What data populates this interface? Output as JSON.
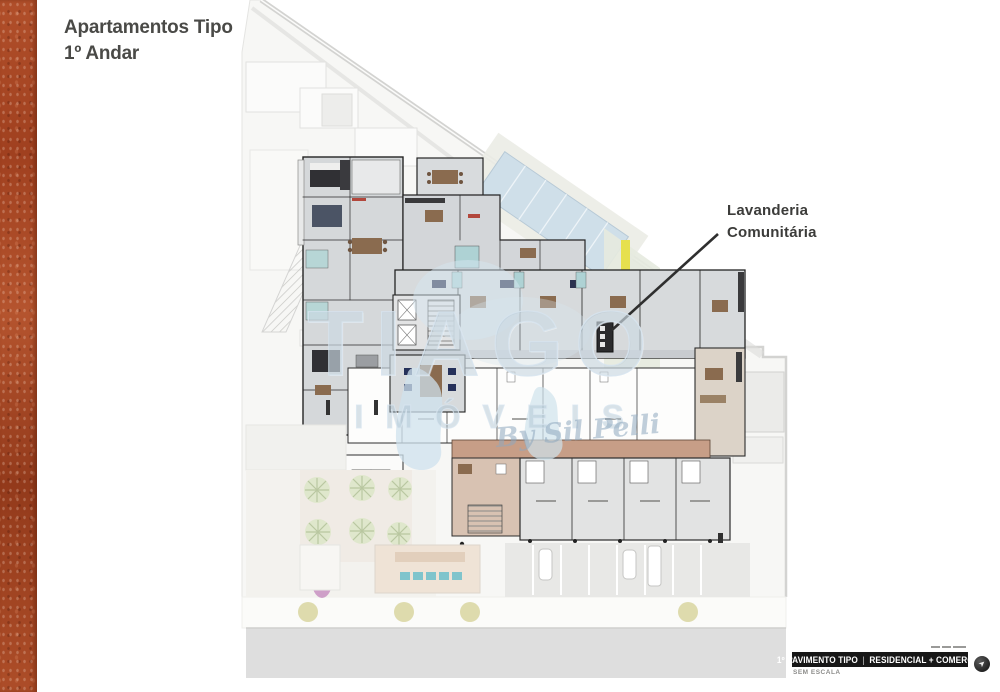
{
  "page": {
    "title": {
      "line1": "Apartamentos Tipo",
      "line2": "1º Andar"
    }
  },
  "plan": {
    "callout": {
      "line1": "Lavanderia",
      "line2": "Comunitária"
    }
  },
  "watermark": {
    "brand_top": "TIAGO",
    "brand_bottom": "IMÓVEIS",
    "tagline": "By Sil Pelli"
  },
  "footer": {
    "title_left": "1º PAVIMENTO TIPO",
    "divider": "|",
    "title_right": "RESIDENCIAL + COMERCIO",
    "scale_note": "SEM ESCALA",
    "compass_icon": "compass-north-icon"
  },
  "colors": {
    "accent_terracotta": "#a84424",
    "ink": "#4a4a47",
    "footer_bar": "#171717",
    "watermark_blue": "#abc0d0",
    "pool_blue": "#cfdfe9",
    "corridor_tan": "#c79e87"
  }
}
